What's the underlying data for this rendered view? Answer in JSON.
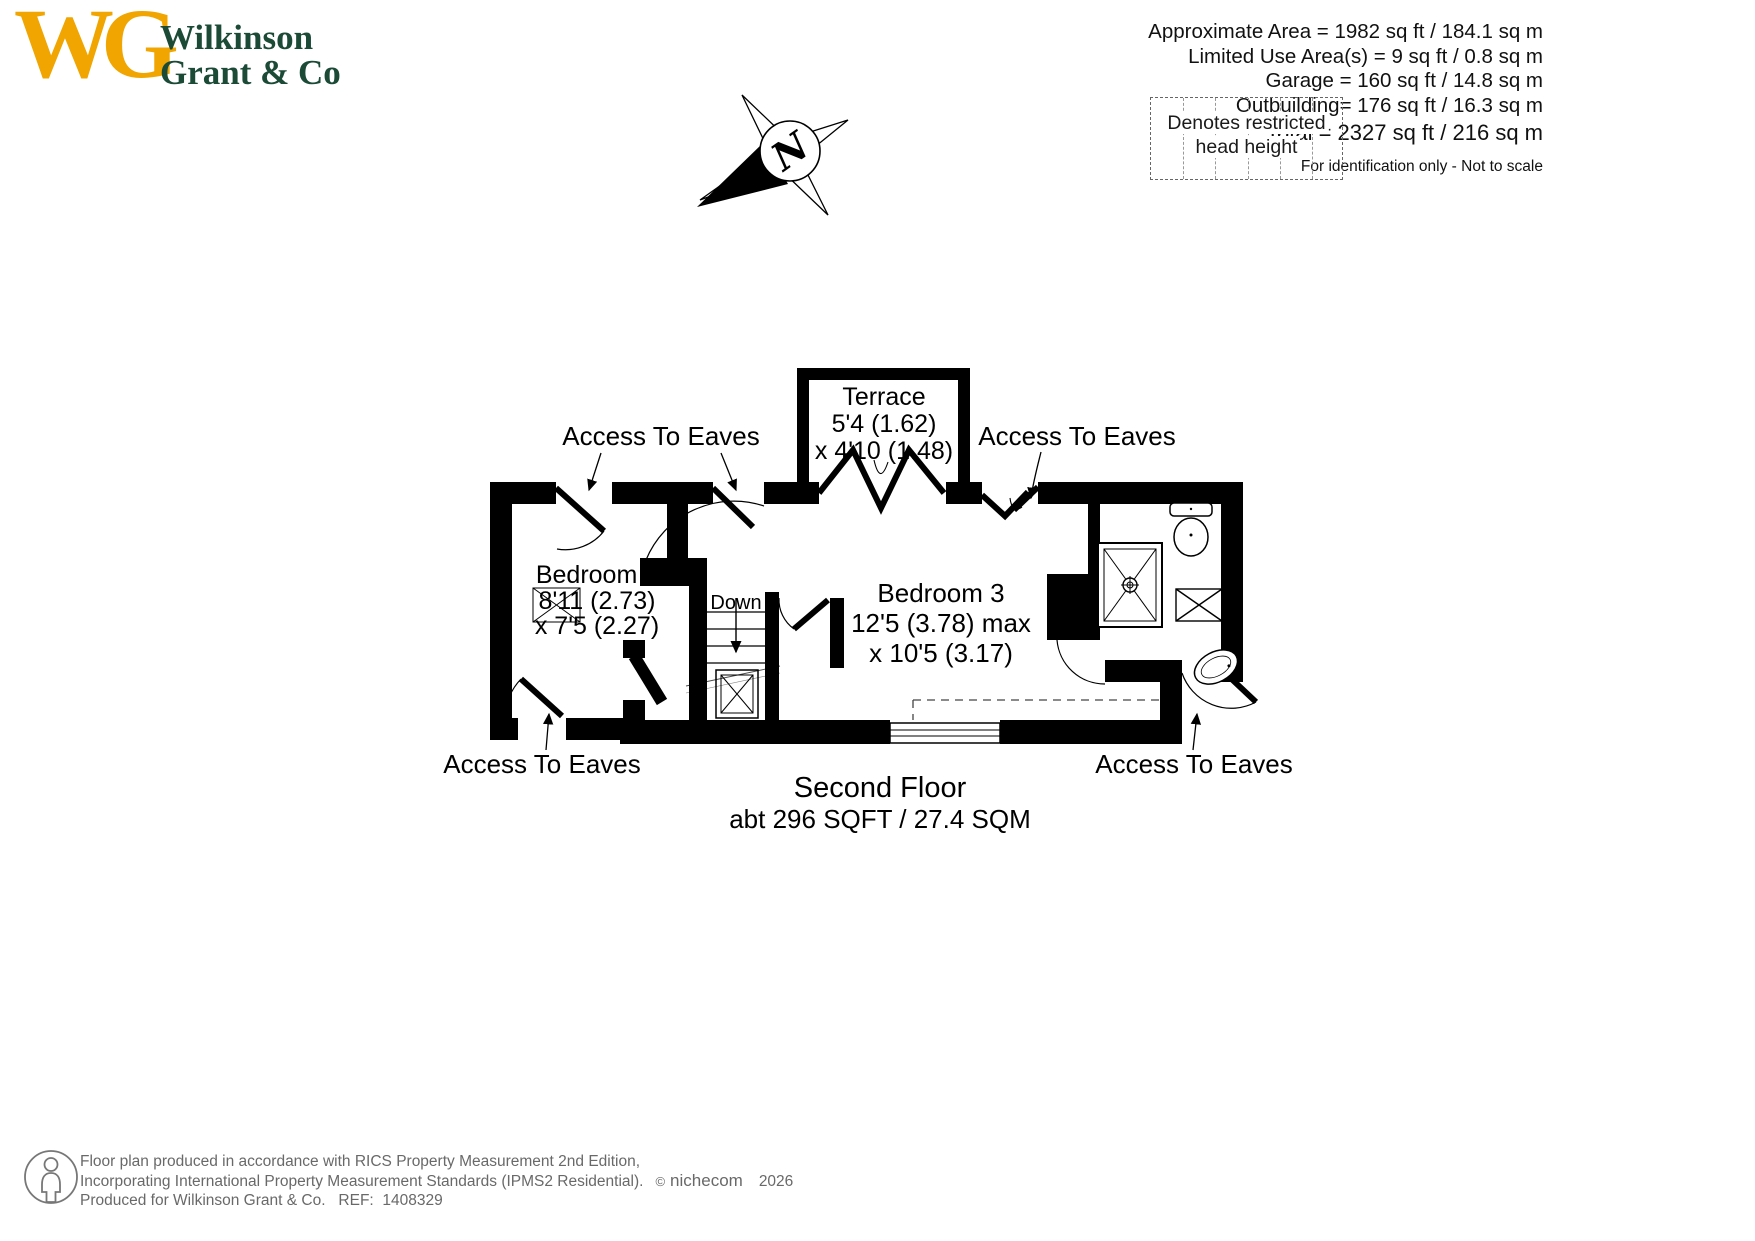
{
  "header": {
    "logo": {
      "monogram": "WG",
      "line1": "Wilkinson",
      "line2": "Grant & Co"
    },
    "areas": [
      "Approximate Area = 1982 sq ft / 184.1 sq m",
      "Limited Use Area(s) = 9 sq ft / 0.8 sq m",
      "Garage = 160 sq ft / 14.8 sq m",
      "Outbuilding= 176 sq ft / 16.3 sq m"
    ],
    "total": "Total = 2327 sq ft / 216 sq m",
    "disclaimer": "For identification only - Not to scale",
    "legend": {
      "line1": "Denotes restricted",
      "line2": "head height"
    },
    "compass_letter": "N"
  },
  "plan": {
    "terrace": {
      "name": "Terrace",
      "dim1": "5'4 (1.62)",
      "dim2": "x 4'10 (1.48)"
    },
    "bedroom5": {
      "name": "Bedroom 5",
      "dim1": "8'11 (2.73)",
      "dim2": "x 7'5 (2.27)"
    },
    "bedroom3": {
      "name": "Bedroom 3",
      "dim1": "12'5 (3.78) max",
      "dim2": "x 10'5 (3.17)"
    },
    "stairs_label": "Down",
    "access_top_left": "Access To Eaves",
    "access_top_right": "Access To Eaves",
    "access_bottom_left": "Access To Eaves",
    "access_bottom_right": "Access To Eaves",
    "floor_title": "Second Floor",
    "floor_area": "abt 296 SQFT / 27.4 SQM"
  },
  "footer": {
    "line1": "Floor plan produced in accordance with RICS Property Measurement 2nd Edition,",
    "line2": "Incorporating International Property Measurement Standards (IPMS2 Residential).",
    "copyright": "©",
    "brand": "nichecom",
    "year": "2026",
    "line3": "Produced for Wilkinson Grant & Co.   REF:  1408329"
  },
  "colors": {
    "gold": "#F0A500",
    "green": "#1B4A37",
    "text_gray": "#696969",
    "line_black": "#000000"
  }
}
